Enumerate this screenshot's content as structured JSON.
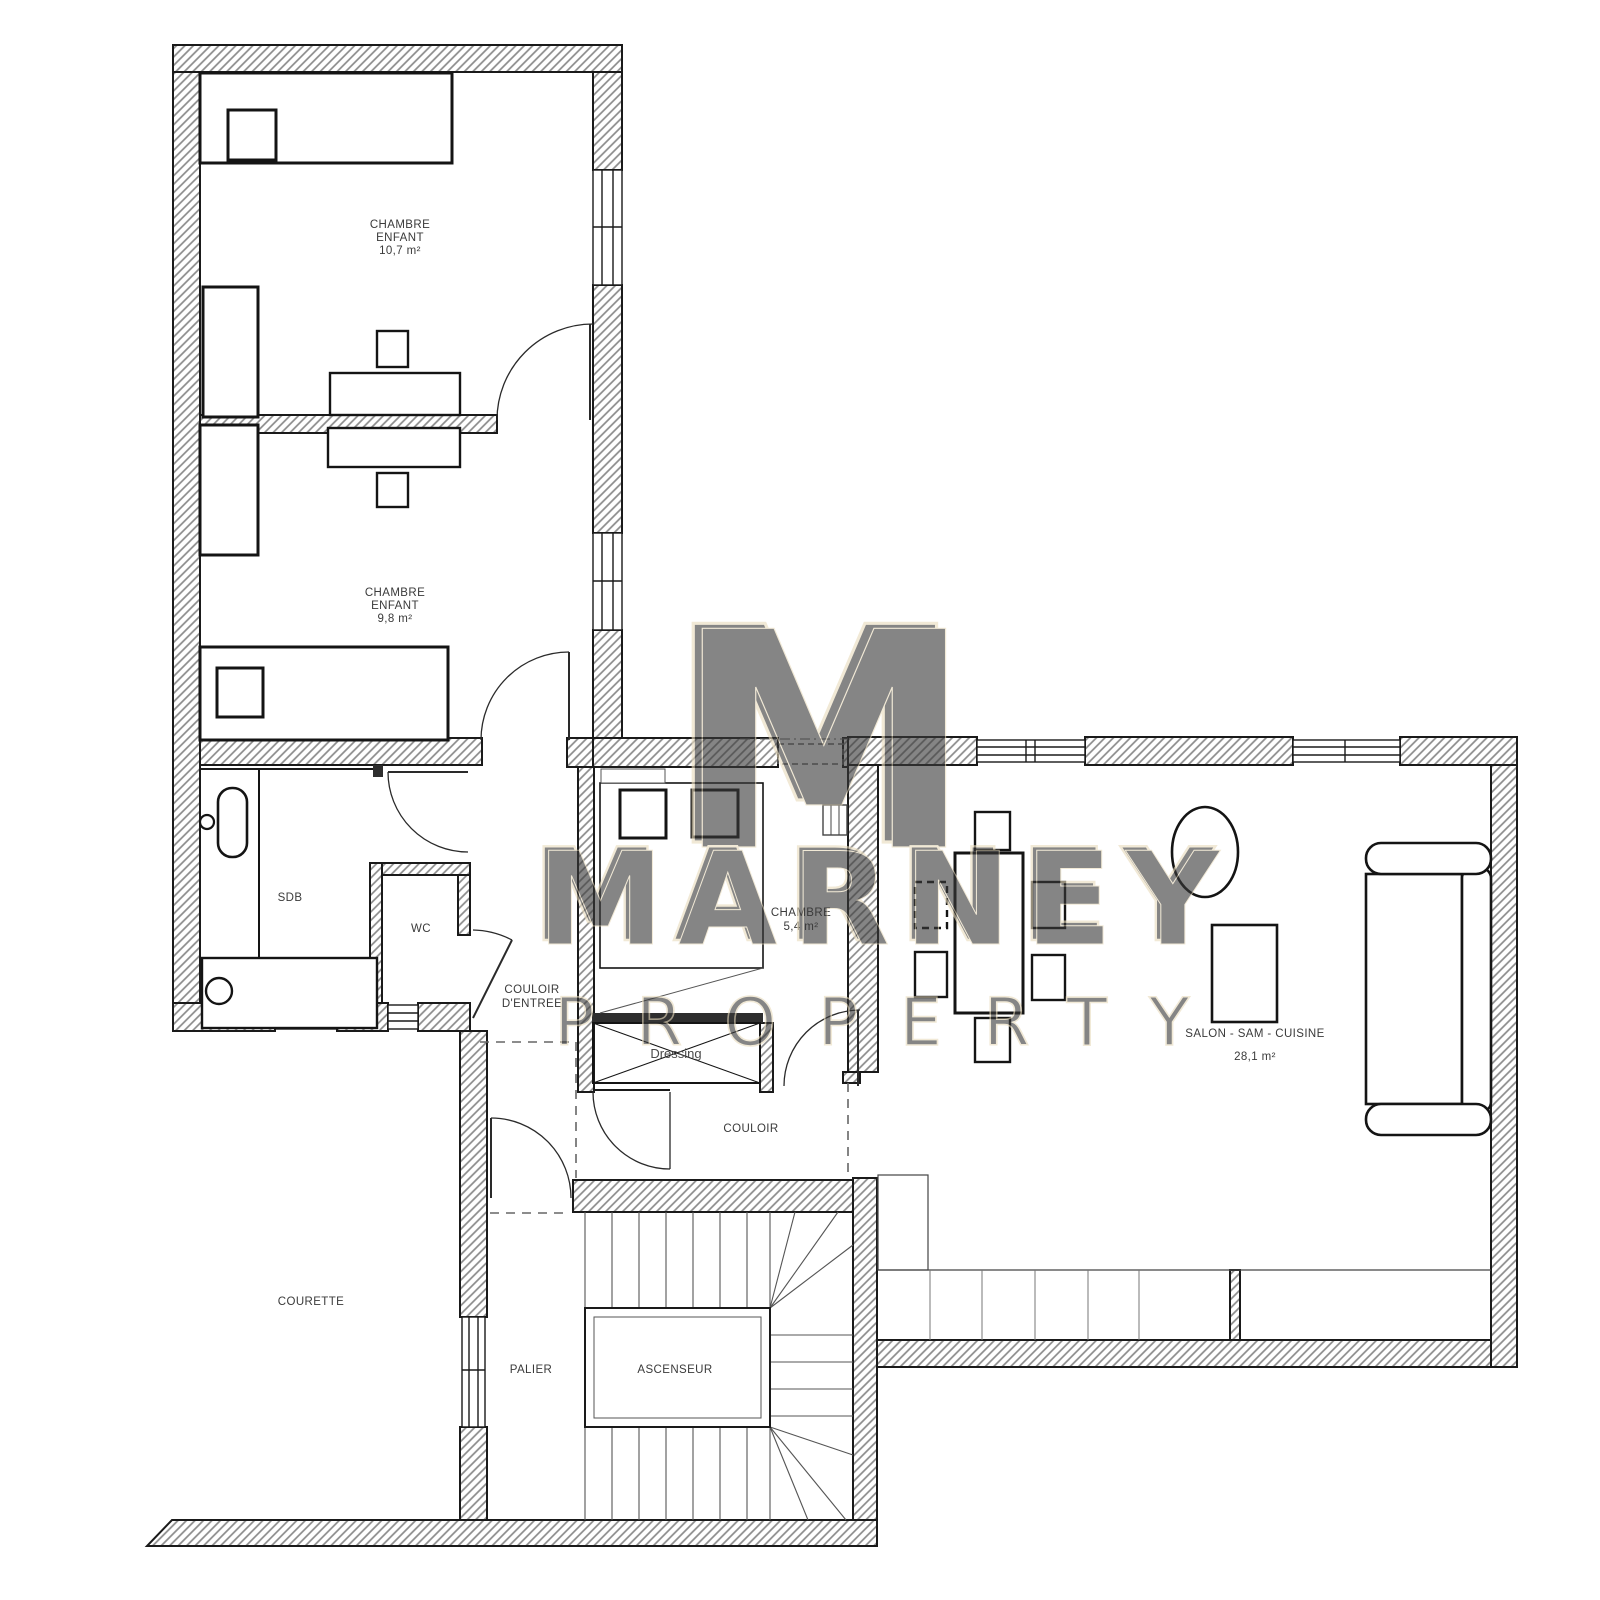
{
  "plan_title": "Floor plan",
  "labels": {
    "room1": [
      "CHAMBRE",
      "ENFANT",
      "10,7 m²"
    ],
    "room2": [
      "CHAMBRE",
      "ENFANT",
      "9,8 m²"
    ],
    "sdb": [
      "SDB"
    ],
    "wc": [
      "WC"
    ],
    "entry": [
      "COULOIR",
      "D'ENTREE"
    ],
    "bedroom3": [
      "CHAMBRE",
      "5,4 m²"
    ],
    "dressing": [
      "Dressing"
    ],
    "couloir": [
      "COULOIR"
    ],
    "living": [
      "SALON - SAM - CUISINE",
      "28,1 m²"
    ],
    "courette": [
      "COURETTE"
    ],
    "palier": [
      "PALIER"
    ],
    "ascenseur": [
      "ASCENSEUR"
    ]
  },
  "watermark": {
    "monogram": "M",
    "name": "MARNEY",
    "subtitle": "PROPERTY",
    "color": "#e8dbbd"
  },
  "colors": {
    "wall_line": "#1a1a1a",
    "hatch": "#8a8a8a",
    "furniture": "#141414",
    "thin": "#555555"
  }
}
